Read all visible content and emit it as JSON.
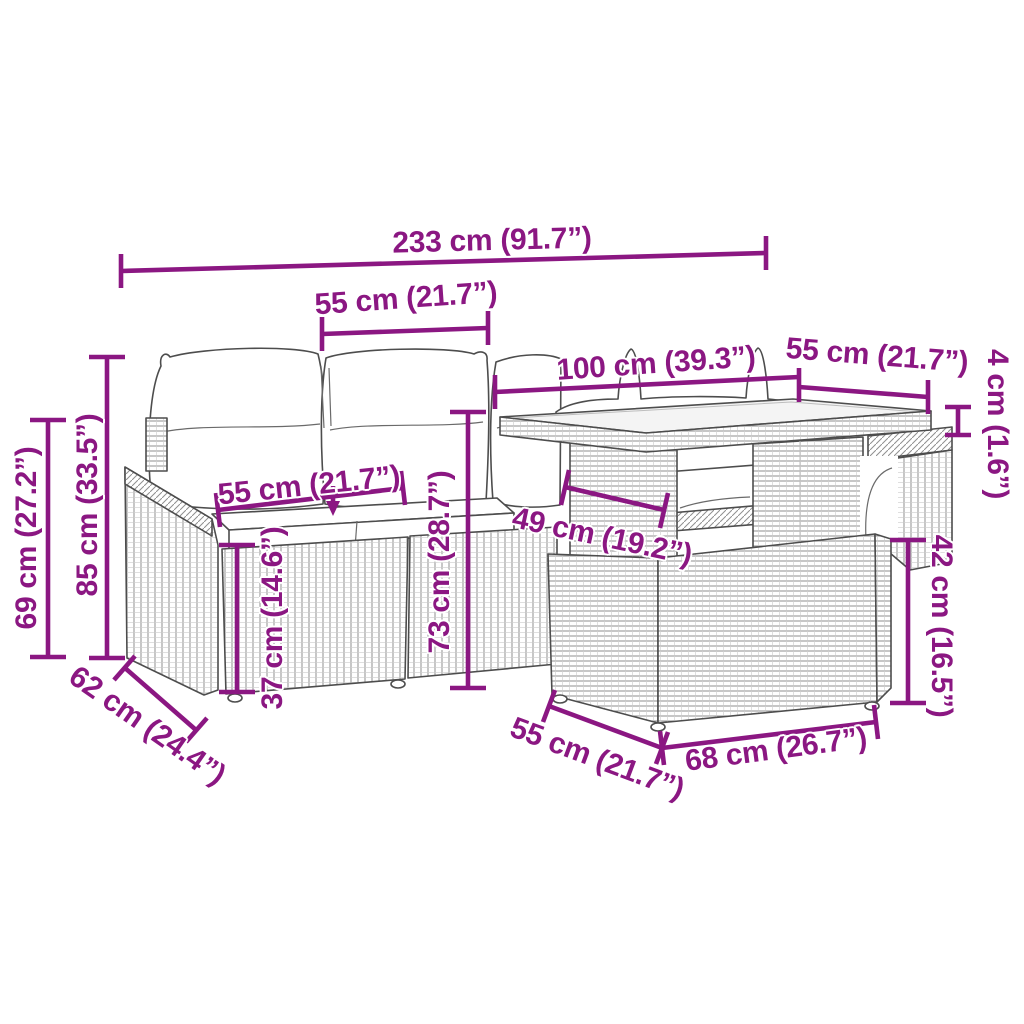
{
  "subject": "garden furniture set dimension diagram",
  "accent_color": "#8B1782",
  "artwork_line_color": "#4d4d4d",
  "cushion_color": "#ffffff",
  "labels": {
    "total_width": "233 cm (91.7”)",
    "backrest_width": "55 cm (21.7”)",
    "table_length": "100 cm (39.3”)",
    "table_depth": "55 cm (21.7”)",
    "tabletop_thickness": "4 cm (1.6”)",
    "armrest_height": "69 cm (27.2”)",
    "total_height": "85 cm (33.5”)",
    "seat_width": "55 cm (21.7”)",
    "seat_height": "37 cm (14.6”)",
    "backrest_height": "73 cm (28.7”)",
    "table_clearance_depth": "49 cm (19.2”)",
    "table_base_height": "42 cm (16.5”)",
    "seat_depth": "62 cm (24.4”)",
    "table_base_depth": "55 cm (21.7”)",
    "table_base_width": "68 cm (26.7”)"
  }
}
